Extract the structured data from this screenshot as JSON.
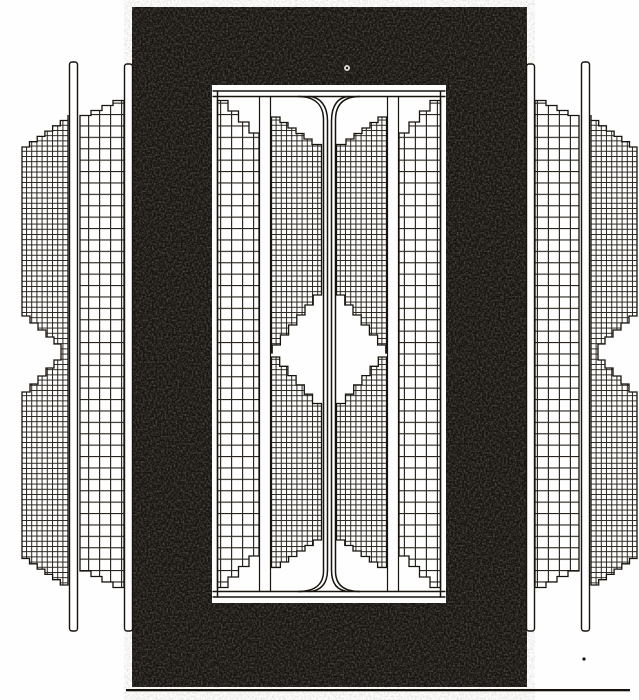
{
  "figure": {
    "kind": "engraved-technical-illustration",
    "subject": "shell-type-transformer-core-and-windings-cross-section",
    "components": [
      {
        "name": "magnetic-core",
        "style": "solid-black-stippled"
      },
      {
        "name": "core-window",
        "style": "white-opening-with-double-frame-lines"
      },
      {
        "name": "center-duct",
        "style": "vertical-tube-with-branching-fillets-top-and-bottom"
      },
      {
        "name": "inner-winding-coarse-left"
      },
      {
        "name": "inner-winding-fine-left"
      },
      {
        "name": "inner-winding-coarse-right"
      },
      {
        "name": "inner-winding-fine-right"
      },
      {
        "name": "outer-winding-fine-left"
      },
      {
        "name": "outer-winding-coarse-left"
      },
      {
        "name": "outer-winding-fine-right"
      },
      {
        "name": "outer-winding-coarse-right"
      },
      {
        "name": "clamp-bars",
        "count": 4
      },
      {
        "name": "baseline-rule"
      }
    ]
  },
  "colors": {
    "paper": "#fefefe",
    "ink": "#17130d",
    "grid": "#29241d",
    "core": "#161310",
    "speck": "#d9d4c9"
  }
}
